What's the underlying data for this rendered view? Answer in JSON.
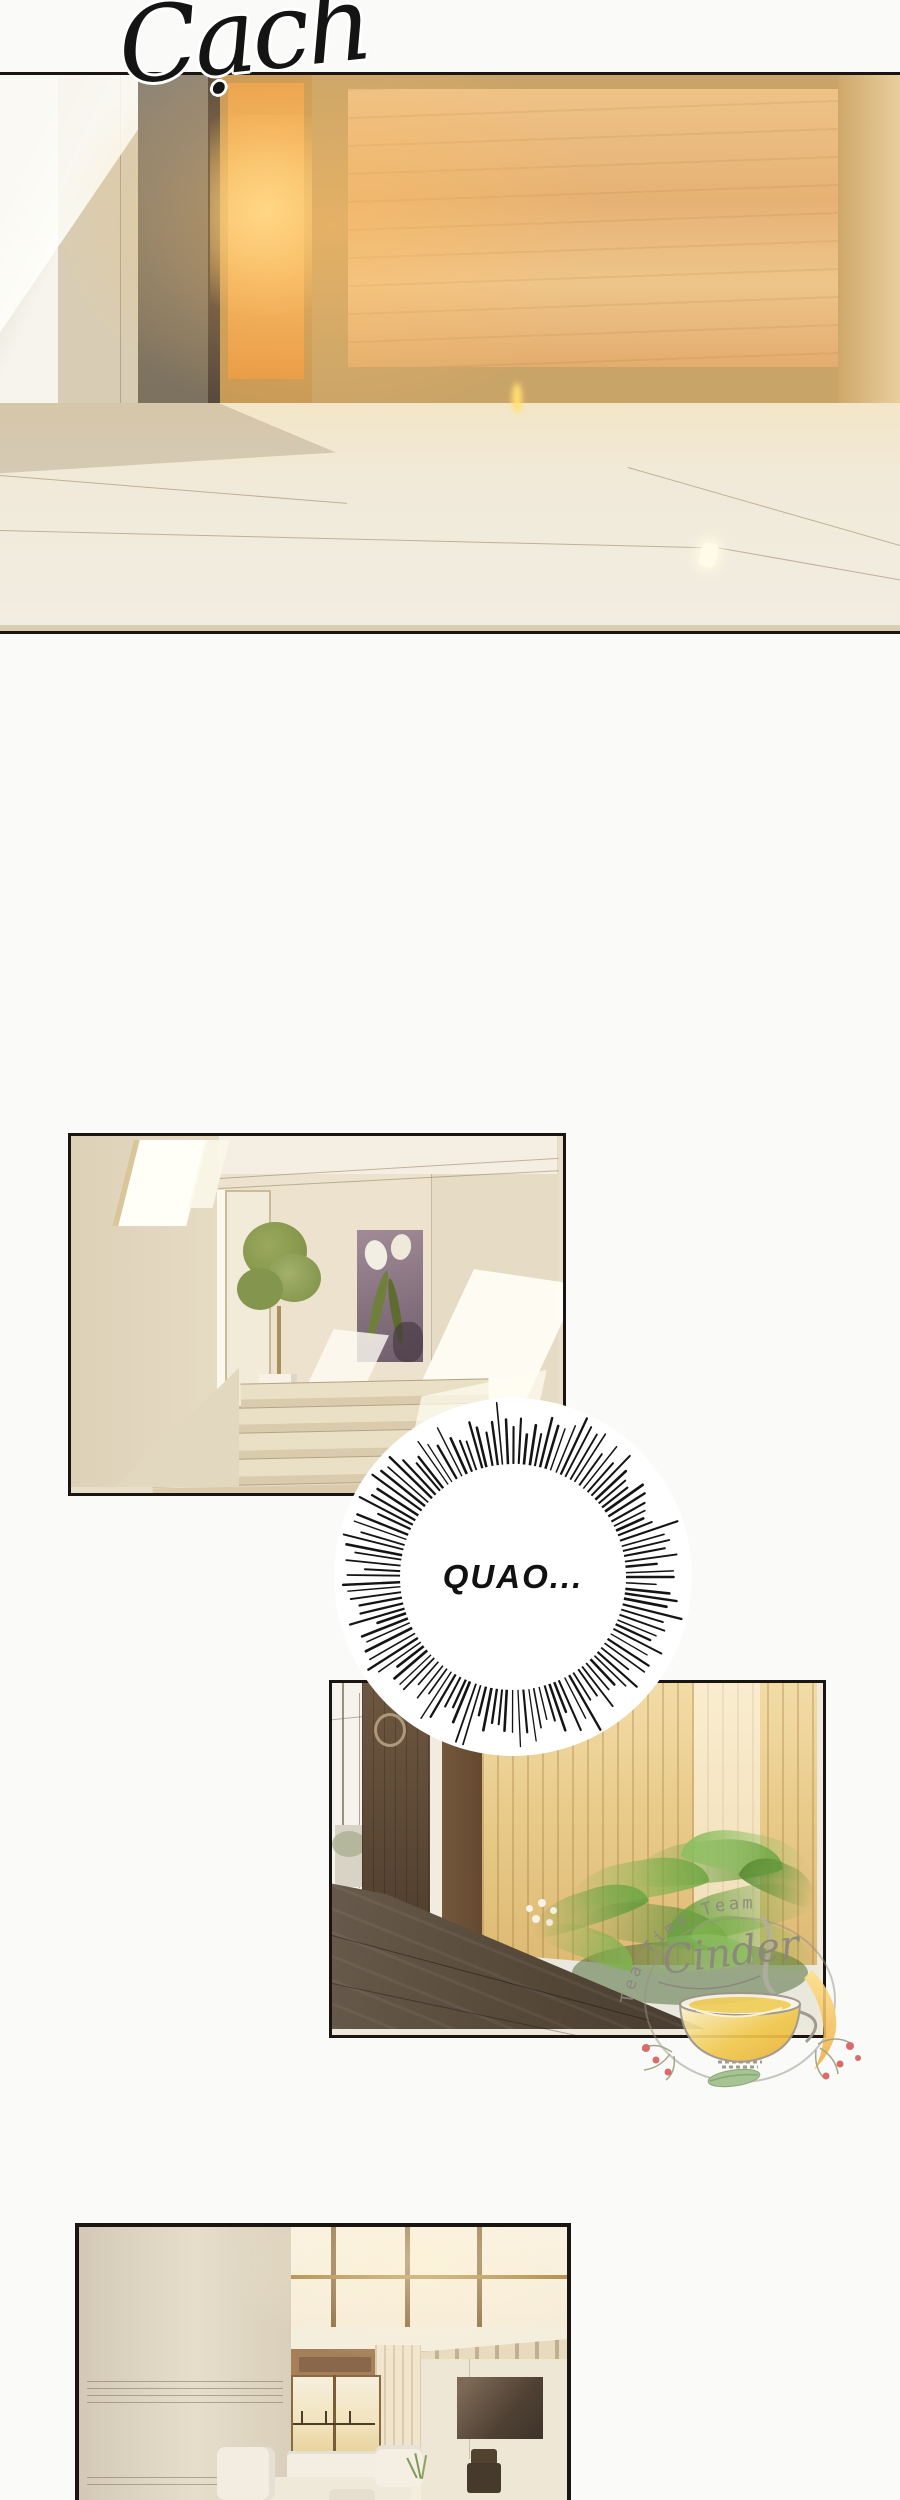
{
  "page": {
    "bg_color": "#fafaf8",
    "panel_border_color": "#1a1510"
  },
  "sfx": {
    "text": "Cạch",
    "color": "#141414"
  },
  "speech_bubble": {
    "text": "QUAO...",
    "text_color": "#111111",
    "spike_color": "#141414",
    "fill": "#ffffff"
  },
  "watermark": {
    "arc_text": "Tea Time Team",
    "script_text": "Cinder",
    "text_color": "#8d867f",
    "tea_color": "#f1c94e",
    "berry_color": "#d85f5f",
    "leaf_color": "#9fc08a"
  },
  "panels": [
    {
      "name": "entry-door-sunlight"
    },
    {
      "name": "staircase-hallway"
    },
    {
      "name": "courtyard-walkway"
    },
    {
      "name": "living-room"
    }
  ],
  "colors": {
    "wood_panel": "#e8b878",
    "orange_door_glow": "#f2a64e",
    "cream_wall": "#e9dfca",
    "floor": "#f0e9d8",
    "fern_green": "#6fa348",
    "deck_brown": "#554637",
    "fence_tan": "#e9cc8a",
    "dark_door_brown": "#5f4a36"
  }
}
